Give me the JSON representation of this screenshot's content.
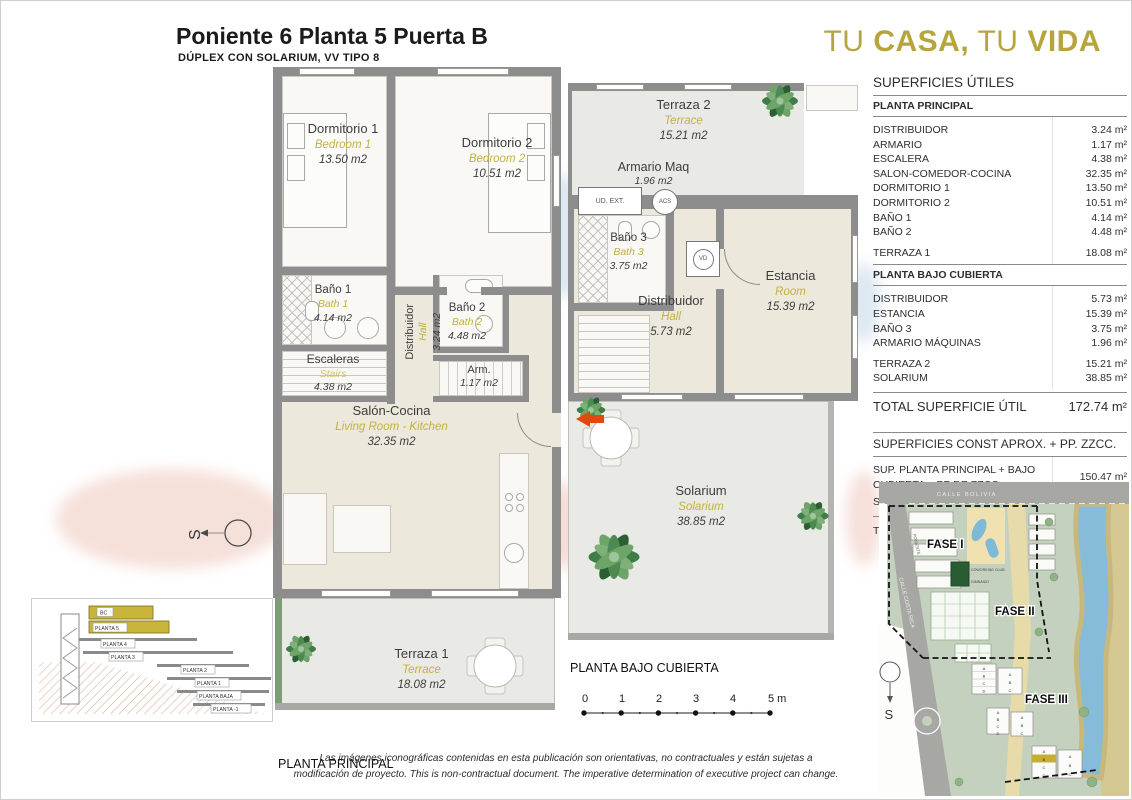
{
  "header": {
    "title": "Poniente 6 Planta 5 Puerta B",
    "subtitle": "DÚPLEX CON SOLARIUM, VV TIPO 8"
  },
  "brand": {
    "tu1": "TU",
    "casa": "CASA,",
    "tu2": "TU",
    "vida": "VIDA"
  },
  "colors": {
    "gold": "#b5a53c",
    "plan_gold": "#c2b23d",
    "wall": "#8d8d8d",
    "arrow": "#e2490c",
    "highlight": "#c4ae33"
  },
  "surfaces": {
    "title": "SUPERFICIES ÚTILES",
    "planta_principal": {
      "heading": "PLANTA PRINCIPAL",
      "rows": [
        {
          "label": "DISTRIBUIDOR",
          "value": "3.24 m²"
        },
        {
          "label": "ARMARIO",
          "value": "1.17 m²"
        },
        {
          "label": "ESCALERA",
          "value": "4.38 m²"
        },
        {
          "label": "SALON-COMEDOR-COCINA",
          "value": "32.35 m²"
        },
        {
          "label": "DORMITORIO 1",
          "value": "13.50 m²"
        },
        {
          "label": "DORMITORIO 2",
          "value": "10.51 m²"
        },
        {
          "label": "BAÑO 1",
          "value": "4.14 m²"
        },
        {
          "label": "BAÑO 2",
          "value": "4.48 m²"
        }
      ],
      "terraza_row": {
        "label": "TERRAZA 1",
        "value": "18.08 m²"
      }
    },
    "planta_bajo": {
      "heading": "PLANTA BAJO CUBIERTA",
      "rows": [
        {
          "label": "DISTRIBUIDOR",
          "value": "5.73 m²"
        },
        {
          "label": "ESTANCIA",
          "value": "15.39 m²"
        },
        {
          "label": "BAÑO 3",
          "value": "3.75 m²"
        },
        {
          "label": "ARMARIO MÁQUINAS",
          "value": "1.96 m²"
        }
      ],
      "terraza_rows": [
        {
          "label": "TERRAZA 2",
          "value": "15.21 m²"
        },
        {
          "label": "SOLARIUM",
          "value": "38.85 m²"
        }
      ]
    },
    "total": {
      "label": "TOTAL SUPERFICIE ÚTIL",
      "value": "172.74 m²"
    }
  },
  "construidas": {
    "title": "SUPERFICIES CONST APROX. + PP. ZZCC.",
    "rows": [
      {
        "label": "SUP. PLANTA PRINCIPAL + BAJO CUBIERTA + PP DE ZZCC",
        "value": "150.47 m²"
      },
      {
        "label": "SUP. TERRAZAS",
        "value": "79.64 m²"
      }
    ],
    "total": {
      "label": "TOTAL VIV. + TERRAZAS + ZZCC",
      "value": "230,11 m²"
    }
  },
  "plan_principal": {
    "caption": "PLANTA PRINCIPAL",
    "dormitorio1": {
      "name": "Dormitorio 1",
      "en": "Bedroom 1",
      "area": "13.50 m2"
    },
    "dormitorio2": {
      "name": "Dormitorio 2",
      "en": "Bedroom 2",
      "area": "10.51 m2"
    },
    "bano1": {
      "name": "Baño 1",
      "en": "Bath 1",
      "area": "4.14 m2"
    },
    "bano2": {
      "name": "Baño 2",
      "en": "Bath 2",
      "area": "4.48 m2"
    },
    "escaleras": {
      "name": "Escaleras",
      "en": "Stairs",
      "area": "4.38 m2"
    },
    "distribuidor": {
      "name": "Distribuidor",
      "en": "Hall",
      "area": "3.24 m2"
    },
    "armario": {
      "name": "Arm.",
      "area": "1.17 m2"
    },
    "salon": {
      "name": "Salón-Cocina",
      "en": "Living Room - Kitchen",
      "area": "32.35 m2"
    },
    "terraza1": {
      "name": "Terraza 1",
      "en": "Terrace",
      "area": "18.08 m2"
    },
    "compass": "S"
  },
  "plan_bajo": {
    "caption": "PLANTA BAJO CUBIERTA",
    "terraza2": {
      "name": "Terraza 2",
      "en": "Terrace",
      "area": "15.21 m2"
    },
    "armario_maq": {
      "name": "Armario Maq",
      "area": "1.96 m2"
    },
    "ud_ext": "UD. EXT.",
    "acs": "ACS",
    "vd": "VD",
    "bano3": {
      "name": "Baño 3",
      "en": "Bath 3",
      "area": "3.75 m2"
    },
    "distribuidor": {
      "name": "Distribuidor",
      "en": "Hall",
      "area": "5.73 m2"
    },
    "estancia": {
      "name": "Estancia",
      "en": "Room",
      "area": "15.39 m2"
    },
    "solarium": {
      "name": "Solarium",
      "en": "Solarium",
      "area": "38.85 m2"
    }
  },
  "scale_bar": {
    "ticks": [
      "0",
      "1",
      "2",
      "3",
      "4",
      "5 m"
    ]
  },
  "section": {
    "floors": [
      "BC",
      "PLANTA 5",
      "PLANTA 4",
      "PLANTA 3",
      "PLANTA 2",
      "PLANTA 1",
      "PLANTA BAJA",
      "PLANTA -1"
    ]
  },
  "site_map": {
    "street_top": "CALLE BOLIVIA",
    "street_left": "CALLE COSTA RICA",
    "fase1": "FASE I",
    "fase2": "FASE II",
    "fase3": "FASE III",
    "coworking": "COWORKING CLUB",
    "gimnasio": "GIMNASIO",
    "poniente": "PONIENTE",
    "blocks": [
      "A",
      "B",
      "C",
      "D"
    ],
    "compass": "S"
  },
  "disclaimer": {
    "line1": "Las imágenes iconográficas contenidas en esta publicación son orientativas, no contractuales y están sujetas a",
    "line2": "modificación de proyecto. This is non-contractual document. The imperative determination of executive project can change."
  }
}
